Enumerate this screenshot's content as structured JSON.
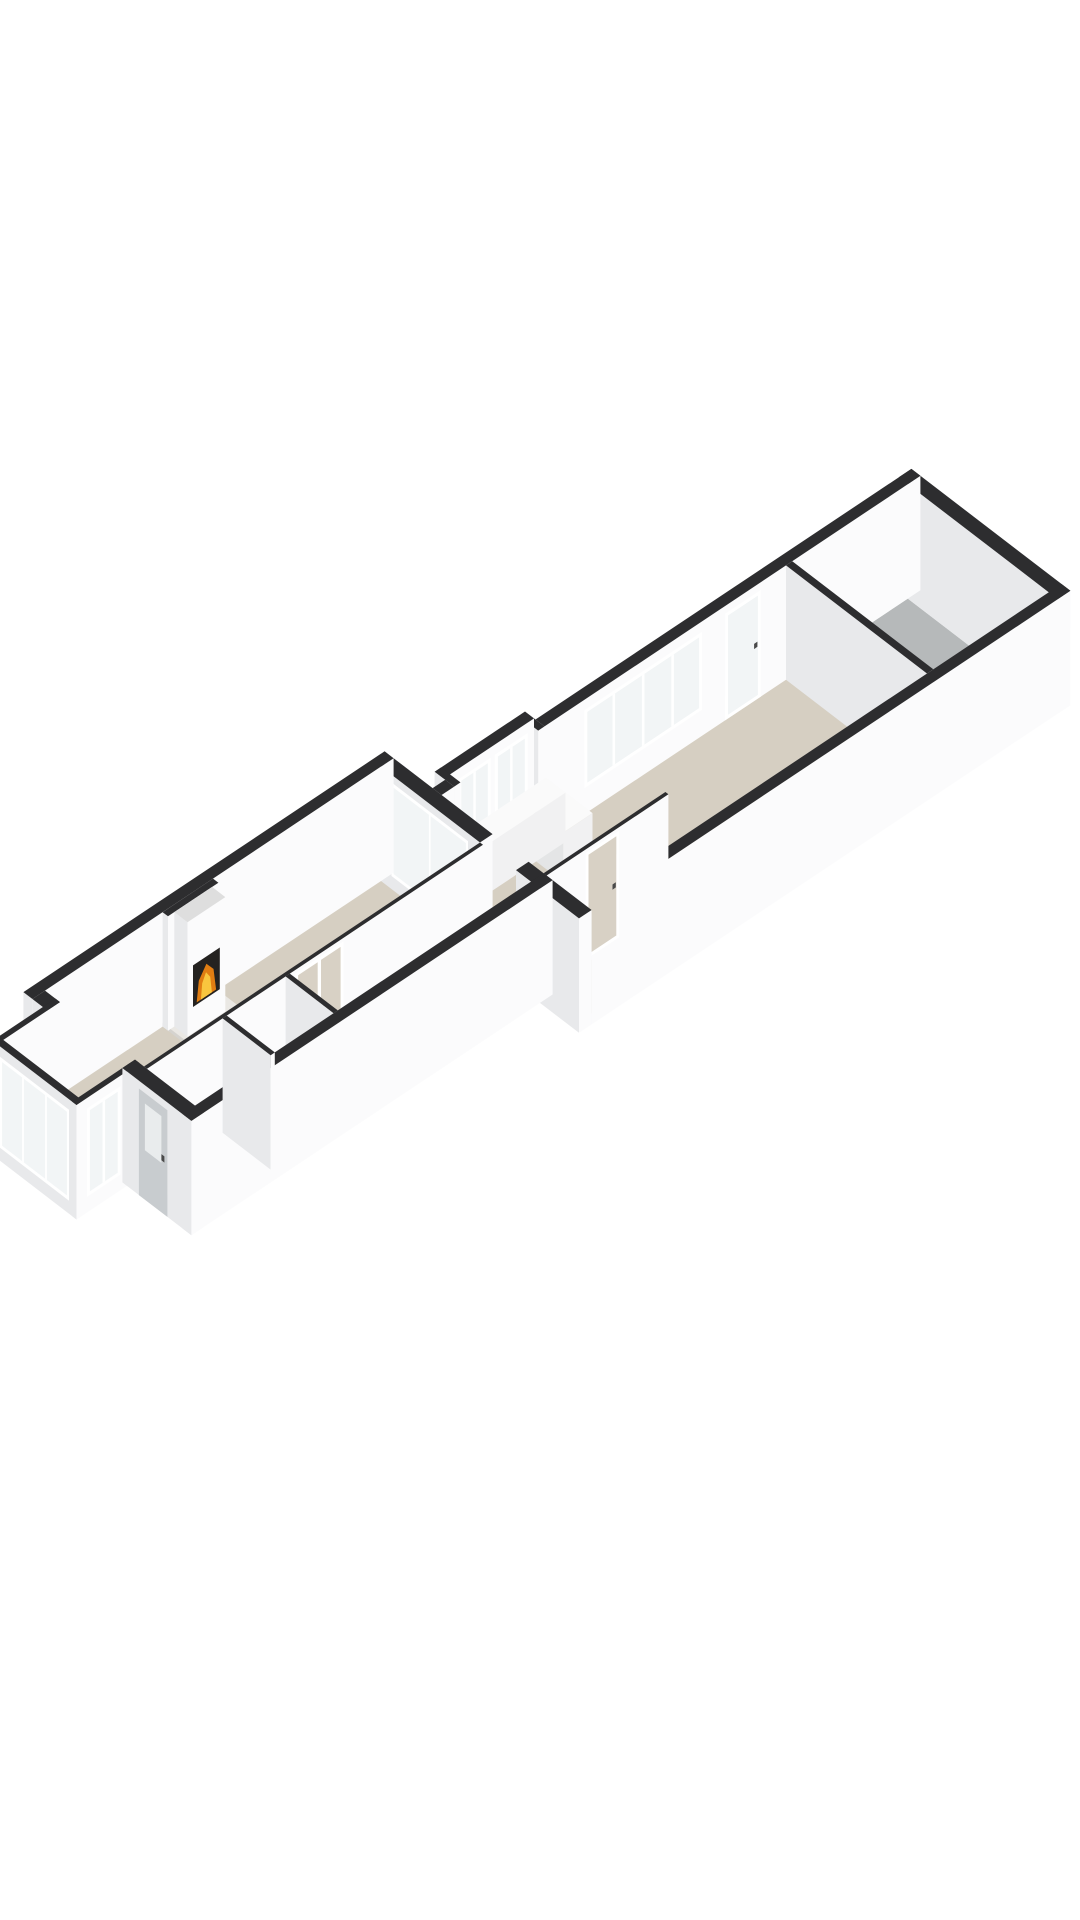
{
  "meta": {
    "kind": "3d-floorplan-render",
    "background": "#ffffff",
    "rooms": [
      "living-room",
      "bay-window",
      "entrance-hall",
      "wc",
      "corridor",
      "kitchen",
      "storage-balcony"
    ],
    "features": [
      "fireplace-with-fire",
      "french-doors",
      "entrance-door",
      "kitchen-counter",
      "stairs",
      "windows"
    ]
  },
  "colors": {
    "background": "#ffffff",
    "wallTop": "#2d2d2f",
    "wallFront": "#fbfbfc",
    "wallSide": "#e8e9eb",
    "floorMain": "#d6cfc2",
    "floorBay": "#dcd6ca",
    "floorBalcony": "#b6b9ba",
    "floorHall": "#f4f4f4",
    "floorWc": "#e3e3e3",
    "glass": "#f2f5f6",
    "glassTint": "#d8d1c5",
    "frame": "#ffffff",
    "door": "#c8cccf",
    "doorLite": "#e9eced",
    "handle": "#4a4a4a",
    "firebox": "#242220",
    "flameOuter": "#e07d12",
    "flameInner": "#f9c63e",
    "counterTop": "#fafafa",
    "counterFront": "#f1f1f2",
    "counterSide": "#e4e5e6",
    "hearthTop": "#eae8e4",
    "hearthFront": "#dddbd7",
    "hearthSide": "#d5d3cf",
    "stairA": "#f1f1f1",
    "stairB": "#e7e7e7",
    "stairEdge": "#c8c8c8"
  },
  "projection": {
    "origin": [
      45,
      1105
    ],
    "ux": 42,
    "uy": -28,
    "vx": 30,
    "vy": 23,
    "zscale": 52,
    "wallHeight": 2.2
  },
  "floors": [
    {
      "name": "floor-living-room",
      "rect": [
        -0.05,
        -0.05,
        8.05,
        3.35
      ],
      "color": "floorMain"
    },
    {
      "name": "floor-corridor",
      "rect": [
        3.35,
        3.3,
        8.6,
        5.05
      ],
      "color": "floorMain"
    },
    {
      "name": "floor-passage",
      "rect": [
        7.9,
        3.3,
        8.35,
        4.55
      ],
      "color": "floorMain"
    },
    {
      "name": "floor-kitchen",
      "rect": [
        8.3,
        1.55,
        16.6,
        6.35
      ],
      "color": "floorMain"
    },
    {
      "name": "floor-kitchen-bump",
      "rect": [
        8.7,
        1.2,
        10.8,
        1.65
      ],
      "color": "floorMain"
    },
    {
      "name": "floor-bay-window",
      "rect": [
        -1.4,
        0.45,
        0.05,
        3.05
      ],
      "color": "floorBay"
    },
    {
      "name": "floor-entrance-hall",
      "rect": [
        0,
        3.4,
        1.8,
        5.0
      ],
      "color": "floorHall"
    },
    {
      "name": "floor-wc",
      "rect": [
        1.9,
        3.4,
        3.3,
        5.0
      ],
      "color": "floorWc"
    },
    {
      "name": "floor-storage-balcony",
      "rect": [
        16.65,
        1.6,
        19.4,
        6.3
      ],
      "color": "floorBalcony"
    }
  ],
  "stairs": {
    "name": "stairs-entrance-hall",
    "x1": 1.05,
    "x2": 1.78,
    "y0": 3.55,
    "step": 0.27,
    "count": 5
  },
  "walls": [
    {
      "name": "wall-nw-living",
      "box": [
        -0.3,
        -0.3,
        8.3,
        0
      ]
    },
    {
      "name": "wall-sw-end-left",
      "box": [
        -0.3,
        0,
        0,
        0.5
      ]
    },
    {
      "name": "wall-sw-end-entrance",
      "box": [
        -0.3,
        3.0,
        0,
        5.3
      ],
      "openings": [
        {
          "face": "xneg",
          "type": "door",
          "a1": 3.55,
          "a2": 4.5,
          "z1": 0,
          "z2": 2.05
        }
      ]
    },
    {
      "name": "bay-wall-nw",
      "box": [
        -1.5,
        0.35,
        0,
        0.5
      ]
    },
    {
      "name": "bay-wall-front",
      "box": [
        -1.5,
        0.35,
        -1.35,
        3.15
      ],
      "openings": [
        {
          "face": "xneg",
          "type": "window",
          "a1": 0.6,
          "a2": 2.9,
          "z1": 0.25,
          "z2": 2.0,
          "mullions": 2
        }
      ]
    },
    {
      "name": "bay-wall-se",
      "box": [
        -1.5,
        3.0,
        0,
        3.15
      ],
      "openings": [
        {
          "face": "ypos",
          "type": "window",
          "a1": -1.25,
          "a2": -0.45,
          "z1": 0.3,
          "z2": 2.0,
          "mullions": 1
        }
      ]
    },
    {
      "name": "wall-se-living",
      "box": [
        -0.3,
        5.0,
        8.3,
        5.3
      ]
    },
    {
      "name": "wall-ne-living-window",
      "box": [
        8.0,
        0,
        8.3,
        3.3
      ],
      "openings": [
        {
          "face": "xneg",
          "type": "window",
          "a1": 0.35,
          "a2": 2.9,
          "z1": 0.25,
          "z2": 2.05,
          "mullions": 1
        }
      ]
    },
    {
      "name": "wall-ne-living-stub",
      "box": [
        8.0,
        4.5,
        8.3,
        6.6
      ]
    },
    {
      "name": "wall-nw-kitchen-link",
      "box": [
        8.3,
        1.3,
        8.6,
        1.6
      ]
    },
    {
      "name": "kitchen-bump-wall-sw",
      "box": [
        8.6,
        0.95,
        8.75,
        1.6
      ],
      "openings": [
        {
          "face": "xneg",
          "type": "window",
          "a1": 1.05,
          "a2": 1.45,
          "z1": 0.85,
          "z2": 2.0,
          "mullions": 0
        }
      ]
    },
    {
      "name": "kitchen-bump-wall-nw",
      "box": [
        8.6,
        0.95,
        10.75,
        1.25
      ],
      "openings": [
        {
          "face": "ypos",
          "type": "window",
          "a1": 8.95,
          "a2": 9.72,
          "z1": 0.8,
          "z2": 2.0,
          "mullions": 1
        },
        {
          "face": "ypos",
          "type": "window",
          "a1": 9.82,
          "a2": 10.6,
          "z1": 0.8,
          "z2": 2.0,
          "mullions": 1
        }
      ]
    },
    {
      "name": "kitchen-bump-wall-ne",
      "box": [
        10.6,
        1.25,
        10.75,
        1.6
      ]
    },
    {
      "name": "wall-nw-kitchen",
      "box": [
        10.75,
        1.3,
        19.7,
        1.6
      ],
      "openings": [
        {
          "face": "ypos",
          "type": "window",
          "a1": 11.7,
          "a2": 14.5,
          "z1": 0.5,
          "z2": 2.0,
          "mullions": 3
        },
        {
          "face": "ypos",
          "type": "glassdoor",
          "a1": 15.05,
          "a2": 15.9,
          "z1": 0,
          "z2": 2.05,
          "glass": "glass"
        }
      ]
    },
    {
      "name": "wall-partition-storage",
      "box": [
        16.5,
        1.6,
        16.65,
        6.3
      ]
    },
    {
      "name": "wall-ne-end",
      "box": [
        19.4,
        1.3,
        19.7,
        6.6
      ]
    },
    {
      "name": "wall-se-kitchen",
      "box": [
        8.3,
        6.3,
        19.7,
        6.6
      ]
    },
    {
      "name": "wall-interior-living",
      "box": [
        0,
        3.3,
        8.0,
        3.4
      ],
      "openings": [
        {
          "face": "yneg",
          "type": "frenchdoor",
          "a1": 3.6,
          "a2": 4.75,
          "z1": 0,
          "z2": 2.05,
          "glass": "glassTint"
        }
      ]
    },
    {
      "name": "wall-hall-east",
      "box": [
        1.8,
        3.4,
        1.9,
        5.0
      ]
    },
    {
      "name": "wall-wc-east",
      "box": [
        3.3,
        3.4,
        3.4,
        5.0
      ]
    },
    {
      "name": "wall-kitchen-stub",
      "box": [
        8.3,
        5.0,
        11.2,
        5.1
      ],
      "openings": [
        {
          "face": "yneg",
          "type": "glassdoor",
          "a1": 9.3,
          "a2": 10.1,
          "z1": 0,
          "z2": 2.05,
          "glass": "glassTint"
        }
      ]
    },
    {
      "name": "chimney-breast",
      "box": [
        2.8,
        0,
        4.0,
        0.18
      ]
    },
    {
      "name": "fireplace",
      "box": [
        2.95,
        0.18,
        3.85,
        0.62
      ],
      "topColor": "#dedede",
      "fire": {
        "face": "ypos",
        "box": [
          3.08,
          0.5,
          3.72,
          1.3
        ],
        "flameOuter": [
          [
            3.17,
            0.54
          ],
          [
            3.63,
            0.54
          ],
          [
            3.57,
            0.97
          ],
          [
            3.4,
            1.16
          ],
          [
            3.22,
            0.93
          ]
        ],
        "flameInner": [
          [
            3.27,
            0.54
          ],
          [
            3.53,
            0.54
          ],
          [
            3.49,
            0.86
          ],
          [
            3.39,
            1.0
          ],
          [
            3.3,
            0.84
          ]
        ]
      }
    },
    {
      "name": "hearth-slab",
      "box": [
        2.8,
        0,
        4.05,
        0.85
      ],
      "h": 0.07,
      "bias": -18,
      "topColor": "#eae8e4",
      "frontColor": "#dddbd7",
      "sideColor": "#d5d3cf"
    },
    {
      "name": "kitchen-counter-a",
      "box": [
        9.0,
        1.3,
        11.0,
        1.95
      ],
      "h": 0.95,
      "topColor": "#fafafa",
      "frontColor": "#f1f1f2",
      "sideColor": "#e4e5e6"
    },
    {
      "name": "kitchen-counter-b",
      "box": [
        10.3,
        1.95,
        11.0,
        2.85
      ],
      "h": 0.95,
      "topColor": "#fafafa",
      "frontColor": "#f1f1f2",
      "sideColor": "#e4e5e6"
    }
  ]
}
